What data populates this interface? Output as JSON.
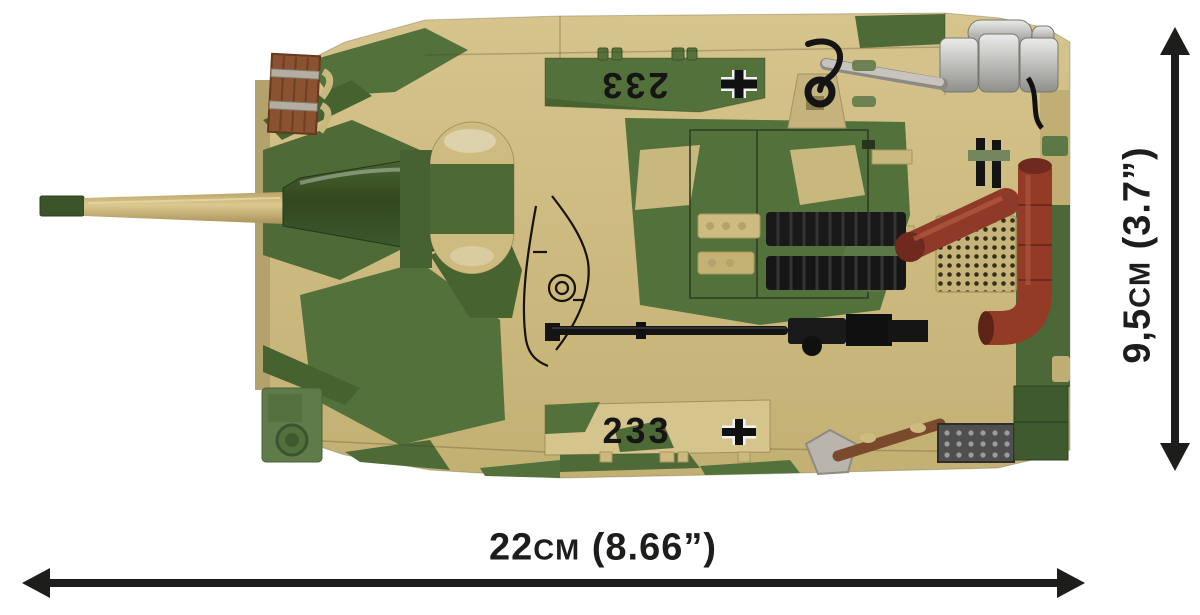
{
  "image": {
    "alt": "Camouflaged brick-built tank model (top view) with size annotations"
  },
  "dimensions": {
    "width": {
      "value": "22",
      "unit": "cm",
      "imperial": "(8.66”)"
    },
    "height": {
      "value": "9,5",
      "unit": "cm",
      "imperial": "(3.7”)"
    }
  },
  "markings": {
    "top_number": "233",
    "bottom_number": "233",
    "insignia": "balkenkreuz-cross"
  },
  "colors": {
    "sand": "#cdbb80",
    "olive": "#53713b",
    "dark_green": "#3c5429",
    "wood_brown": "#8a5230",
    "silver": "#c2c0ba",
    "exhaust_red": "#943b27",
    "black_parts": "#161616",
    "annotation": "#1d1d1b"
  }
}
